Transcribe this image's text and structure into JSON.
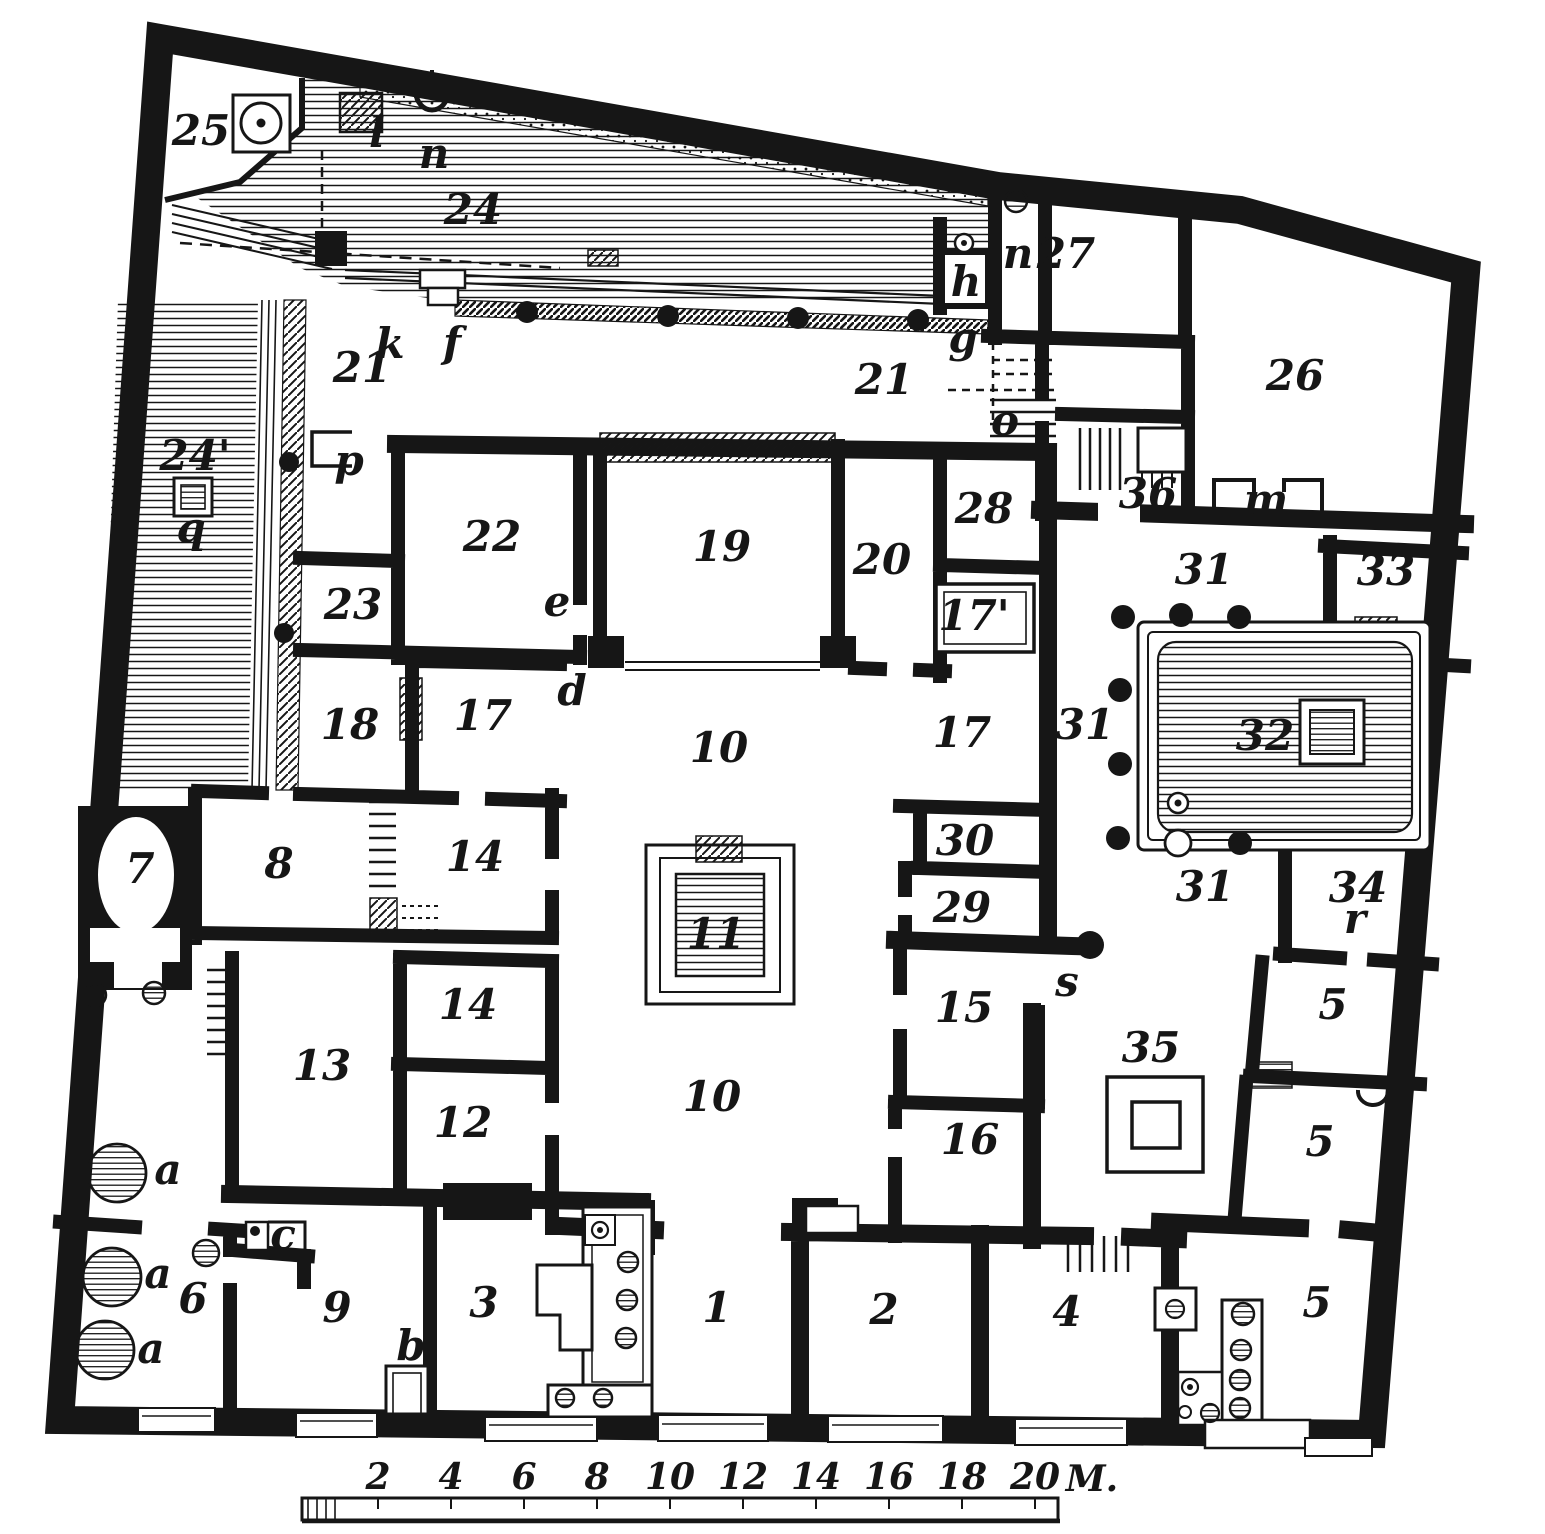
{
  "plan": {
    "labels": [
      {
        "t": "25",
        "x": 201,
        "y": 145
      },
      {
        "t": "l",
        "x": 377,
        "y": 147,
        "s": 40
      },
      {
        "t": "n",
        "x": 434,
        "y": 168,
        "s": 40
      },
      {
        "t": "24",
        "x": 473,
        "y": 224
      },
      {
        "t": "24'",
        "x": 195,
        "y": 470
      },
      {
        "t": "q",
        "x": 191,
        "y": 542,
        "s": 40
      },
      {
        "t": "k",
        "x": 390,
        "y": 358,
        "s": 40
      },
      {
        "t": "f",
        "x": 452,
        "y": 357,
        "s": 40
      },
      {
        "t": "21",
        "x": 362,
        "y": 382
      },
      {
        "t": "p",
        "x": 349,
        "y": 475,
        "s": 40
      },
      {
        "t": "21",
        "x": 884,
        "y": 394
      },
      {
        "t": "g",
        "x": 963,
        "y": 352,
        "s": 40
      },
      {
        "t": "h",
        "x": 966,
        "y": 296,
        "s": 40
      },
      {
        "t": "n",
        "x": 1018,
        "y": 268,
        "s": 40
      },
      {
        "t": "27",
        "x": 1066,
        "y": 268
      },
      {
        "t": "o",
        "x": 1005,
        "y": 435,
        "s": 40
      },
      {
        "t": "26",
        "x": 1295,
        "y": 390
      },
      {
        "t": "36",
        "x": 1148,
        "y": 508
      },
      {
        "t": "m",
        "x": 1266,
        "y": 514,
        "s": 40
      },
      {
        "t": "22",
        "x": 492,
        "y": 551
      },
      {
        "t": "19",
        "x": 722,
        "y": 561
      },
      {
        "t": "20",
        "x": 882,
        "y": 574
      },
      {
        "t": "28",
        "x": 984,
        "y": 523
      },
      {
        "t": "23",
        "x": 353,
        "y": 619
      },
      {
        "t": "e",
        "x": 557,
        "y": 616,
        "s": 40
      },
      {
        "t": "d",
        "x": 572,
        "y": 705,
        "s": 40
      },
      {
        "t": "18",
        "x": 350,
        "y": 739
      },
      {
        "t": "17",
        "x": 483,
        "y": 730
      },
      {
        "t": "10",
        "x": 719,
        "y": 762
      },
      {
        "t": "17",
        "x": 962,
        "y": 747
      },
      {
        "t": "17'",
        "x": 974,
        "y": 630,
        "s": 38
      },
      {
        "t": "31",
        "x": 1204,
        "y": 584
      },
      {
        "t": "33",
        "x": 1386,
        "y": 585
      },
      {
        "t": "31",
        "x": 1085,
        "y": 739
      },
      {
        "t": "32",
        "x": 1265,
        "y": 750
      },
      {
        "t": "31",
        "x": 1205,
        "y": 901
      },
      {
        "t": "34",
        "x": 1358,
        "y": 902
      },
      {
        "t": "r",
        "x": 1355,
        "y": 933,
        "s": 38
      },
      {
        "t": "7",
        "x": 140,
        "y": 883
      },
      {
        "t": "8",
        "x": 279,
        "y": 878
      },
      {
        "t": "14",
        "x": 475,
        "y": 871
      },
      {
        "t": "11",
        "x": 716,
        "y": 948,
        "s": 38
      },
      {
        "t": "30",
        "x": 965,
        "y": 855
      },
      {
        "t": "29",
        "x": 962,
        "y": 922
      },
      {
        "t": "s",
        "x": 1067,
        "y": 996,
        "s": 40
      },
      {
        "t": "15",
        "x": 964,
        "y": 1022
      },
      {
        "t": "14",
        "x": 468,
        "y": 1019
      },
      {
        "t": "13",
        "x": 322,
        "y": 1080
      },
      {
        "t": "12",
        "x": 463,
        "y": 1137
      },
      {
        "t": "10",
        "x": 712,
        "y": 1111
      },
      {
        "t": "16",
        "x": 970,
        "y": 1154
      },
      {
        "t": "35",
        "x": 1151,
        "y": 1062
      },
      {
        "t": "5",
        "x": 1333,
        "y": 1019
      },
      {
        "t": "5",
        "x": 1320,
        "y": 1156
      },
      {
        "t": "a",
        "x": 168,
        "y": 1184,
        "s": 40
      },
      {
        "t": "a",
        "x": 158,
        "y": 1288,
        "s": 40
      },
      {
        "t": "6",
        "x": 193,
        "y": 1313,
        "s": 40
      },
      {
        "t": "c",
        "x": 283,
        "y": 1249,
        "s": 38
      },
      {
        "t": "9",
        "x": 337,
        "y": 1322
      },
      {
        "t": "a",
        "x": 151,
        "y": 1363,
        "s": 40
      },
      {
        "t": "b",
        "x": 411,
        "y": 1360,
        "s": 40
      },
      {
        "t": "3",
        "x": 484,
        "y": 1317
      },
      {
        "t": "1",
        "x": 717,
        "y": 1322
      },
      {
        "t": "2",
        "x": 884,
        "y": 1324
      },
      {
        "t": "4",
        "x": 1067,
        "y": 1326
      },
      {
        "t": "5",
        "x": 1317,
        "y": 1317
      }
    ]
  },
  "scale_bar": {
    "ticks": [
      {
        "label": "2",
        "x": 378
      },
      {
        "label": "4",
        "x": 451
      },
      {
        "label": "6",
        "x": 524
      },
      {
        "label": "8",
        "x": 597
      },
      {
        "label": "10",
        "x": 670
      },
      {
        "label": "12",
        "x": 743
      },
      {
        "label": "14",
        "x": 816
      },
      {
        "label": "16",
        "x": 889
      },
      {
        "label": "18",
        "x": 962
      },
      {
        "label": "20",
        "x": 1035
      }
    ],
    "unit": {
      "label": "M.",
      "x": 1092
    },
    "label_baseline_y": 1489,
    "bar": {
      "x1": 302,
      "x2": 1058,
      "y1": 1498,
      "y2": 1520
    }
  },
  "colors": {
    "ink": "#161616",
    "paper": "#ffffff"
  }
}
